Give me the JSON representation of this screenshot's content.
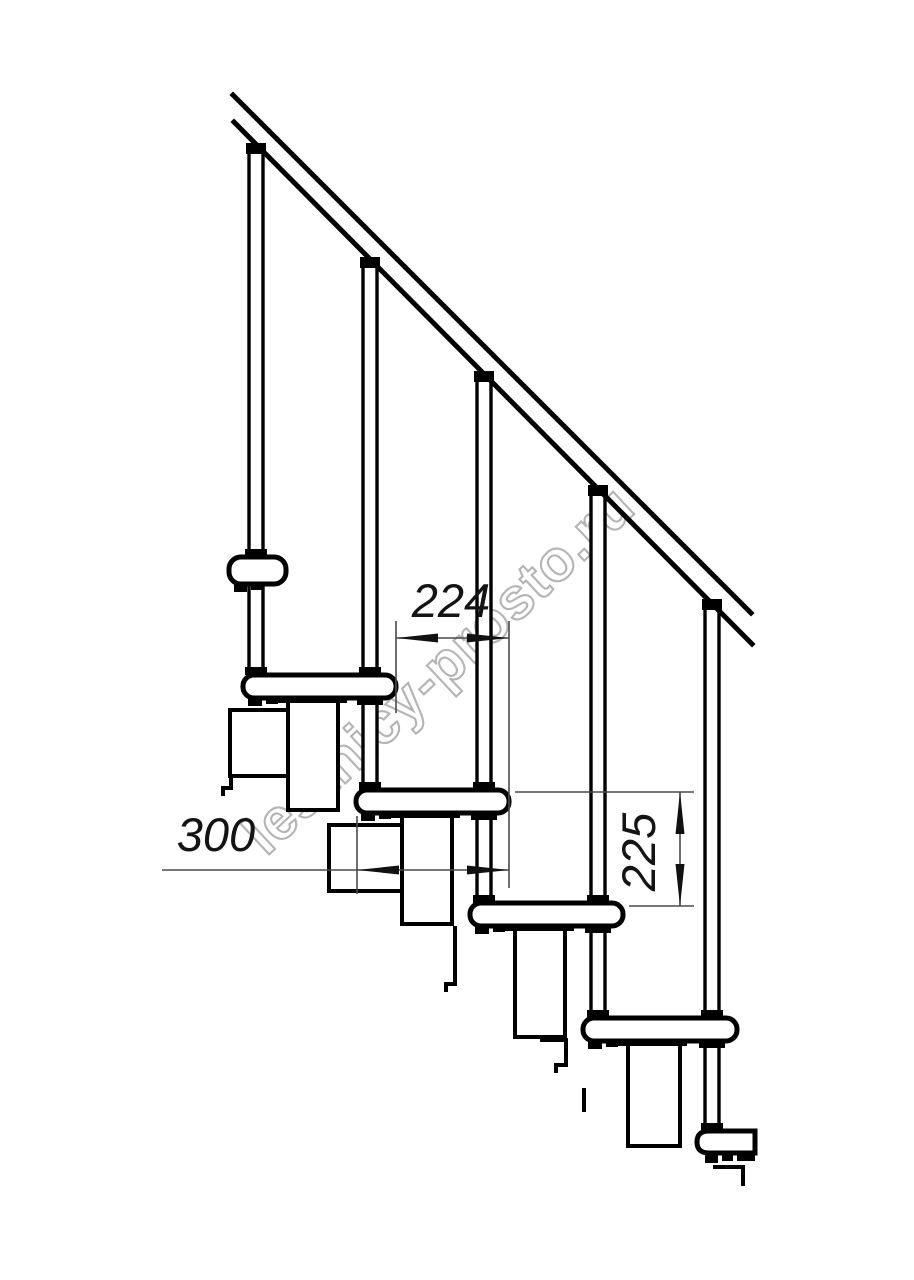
{
  "drawing": {
    "watermark": "lestnicy-prosto.ru",
    "dimensions": {
      "going": "224",
      "depth": "300",
      "rise": "225"
    },
    "colors": {
      "line": "#000000",
      "thin_line": "#4a4a4a",
      "dim_text": "#141414",
      "watermark_outline": "#b4b4b4",
      "background": "#ffffff"
    }
  }
}
